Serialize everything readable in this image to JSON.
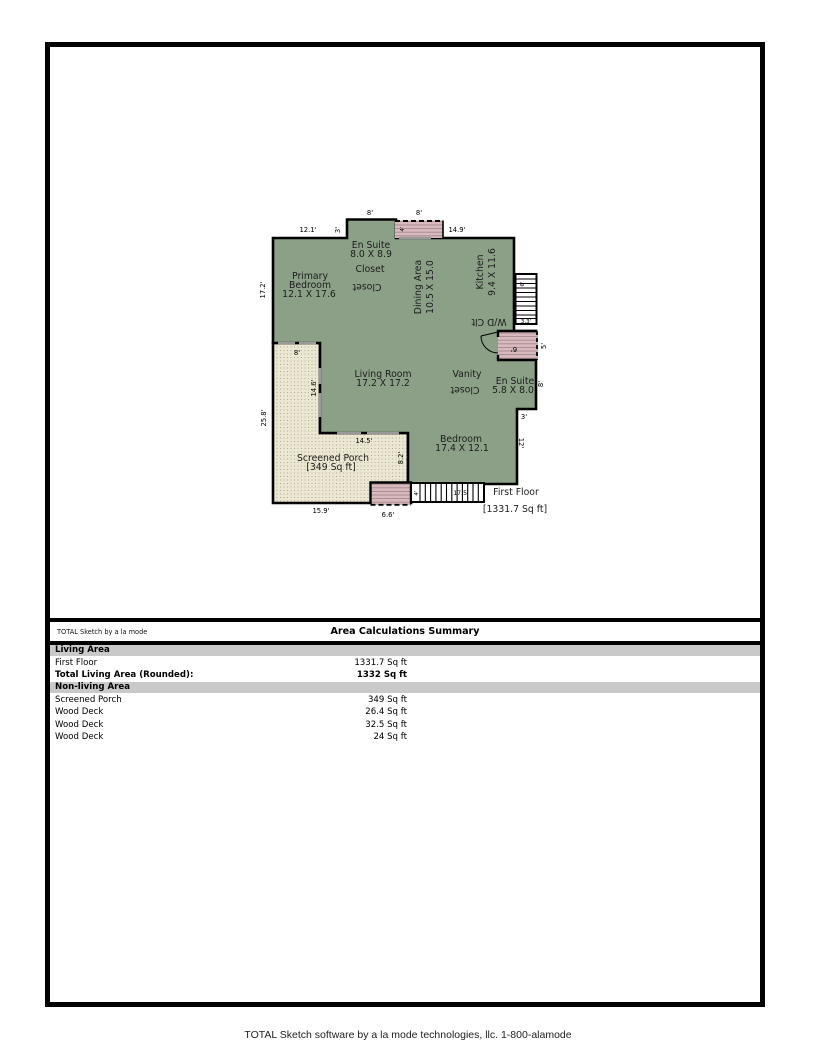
{
  "colors": {
    "room_fill": "#8ca087",
    "porch_fill": "#ece7d2",
    "deck_fill": "#d9b9bd",
    "band_gray": "#c9c9c9"
  },
  "plan": {
    "rooms": {
      "primary_bedroom": {
        "l1": "Primary",
        "l2": "Bedroom",
        "dims": "12.1 X 17.6"
      },
      "en_suite_top": {
        "name": "En Suite",
        "dims": "8.0 X 8.9"
      },
      "closet_top": "Closet",
      "closet_top_flipped": "Closet",
      "dining": {
        "name": "Dining Area",
        "dims": "10.5 X 15.0"
      },
      "kitchen": {
        "name": "Kitchen",
        "dims": "9.4 X 11.6"
      },
      "wd_closet": "W/D Clt",
      "vanity": "Vanity",
      "vanity_closet_flipped": "Closet",
      "en_suite_right": {
        "name": "En Suite",
        "dims": "5.8 X 8.0"
      },
      "living_room": {
        "name": "Living Room",
        "dims": "17.2 X 17.2"
      },
      "bedroom": {
        "name": "Bedroom",
        "dims": "17.4 X 12.1"
      },
      "screened_porch": {
        "name": "Screened Porch",
        "area": "[349 Sq ft]"
      },
      "first_floor": {
        "name": "First Floor",
        "area": "[1331.7 Sq ft]"
      }
    },
    "dims": {
      "top_bump_width": "8'",
      "top_deck_width": "8'",
      "top_left_width": "12.1'",
      "bump_side": "3'",
      "top_right_width": "14.9'",
      "left_upper": "17.2'",
      "left_lower": "25.8'",
      "porch_door": "8'",
      "porch_right_upper": "14.6'",
      "porch_mid": "14.5'",
      "porch_step": "8.2'",
      "porch_bottom": "15.9'",
      "bottom_deck_width": "6.6'",
      "bottom_stairs_first": "4'",
      "bottom_stairs_len": "17.5'",
      "right_stairs_len": "6'",
      "right_stairs_width": "3.3'",
      "right_deck_w": "6'",
      "right_deck_h": "5'",
      "ensuite_side": "8'",
      "jog": "3'",
      "bedroom_side": "12'",
      "top_deck_depth": "4'"
    }
  },
  "summary": {
    "brand": "TOTAL Sketch by a la mode",
    "title": "Area Calculations Summary",
    "living_header": "Living Area",
    "rows_living": [
      {
        "label": "First Floor",
        "value": "1331.7 Sq ft"
      },
      {
        "label": "Total Living Area (Rounded):",
        "value": "1332 Sq ft"
      }
    ],
    "nonliving_header": "Non-living Area",
    "rows_nonliving": [
      {
        "label": "Screened Porch",
        "value": "349 Sq ft"
      },
      {
        "label": "Wood Deck",
        "value": "26.4 Sq ft"
      },
      {
        "label": "Wood Deck",
        "value": "32.5 Sq ft"
      },
      {
        "label": "Wood Deck",
        "value": "24 Sq ft"
      }
    ]
  },
  "footer": "TOTAL Sketch software by a la mode technologies, llc. 1-800-alamode"
}
